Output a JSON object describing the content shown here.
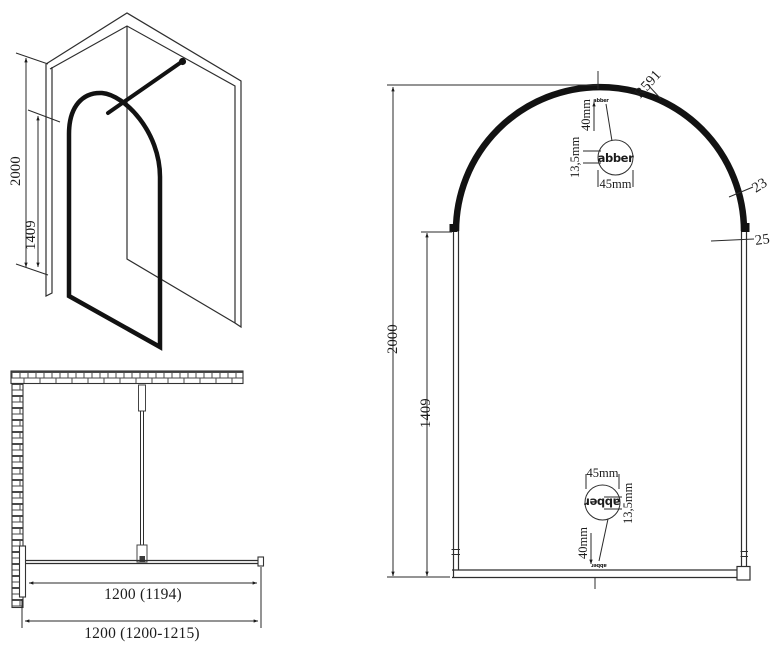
{
  "drawing": {
    "brand_logo": "abber",
    "perspective": {
      "height_total": "2000",
      "height_to_arch": "1409"
    },
    "plan": {
      "glass_width": "1200 (1194)",
      "total_width": "1200 (1200-1215)"
    },
    "front": {
      "height_total": "2000",
      "height_to_arch": "1409",
      "radius": "R591",
      "arch_profile_width": "23",
      "side_profile_width": "25",
      "top_detail": {
        "offset_from_edge": "40mm",
        "logo_height": "13,5mm",
        "logo_width": "45mm",
        "logo": "abber"
      },
      "bottom_detail": {
        "offset_from_edge": "40mm",
        "logo_height": "13,5mm",
        "logo_width": "45mm",
        "logo": "abber"
      }
    }
  }
}
